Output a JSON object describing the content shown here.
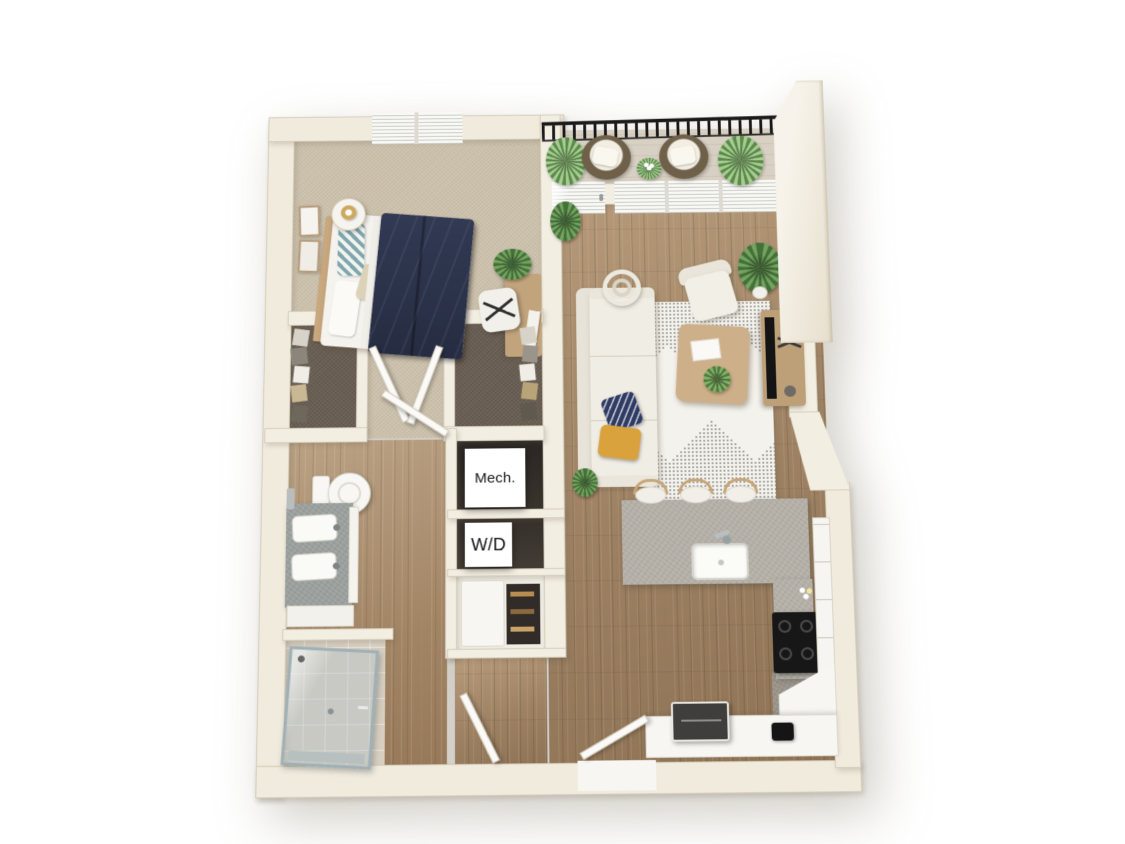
{
  "image": {
    "type": "3d-apartment-floor-plan-rendering",
    "background": "#ffffff"
  },
  "labels": {
    "mechanical": "Mech.",
    "washer_dryer": "W/D"
  },
  "palette": {
    "wall": "#f3eee2",
    "wall_edge": "#d9d1bf",
    "carpet_bedroom": "#cdc2ad",
    "carpet_closet": "#6b6054",
    "wood_floor": "#a8906f",
    "wood_floor_light": "#b09677",
    "tile_shower": "#d8cfc1",
    "kitchen_floor_gray": "#9a948b",
    "counter_stone": "#b4b0a8",
    "cabinet_white": "#f7f6f2",
    "bed_duvet": "#2c3349",
    "sofa": "#f0ede4",
    "pillow_navy": "#2f3b63",
    "pillow_mustard": "#d9a23c",
    "rug_base": "#f4f2ec",
    "rug_pattern": "#232323",
    "balcony_railing": "#191919",
    "plant_green": "#5d8a4c",
    "wood_furniture": "#c8a87e",
    "appliance_dark": "#1d1d1d",
    "label_text": "#141414"
  }
}
